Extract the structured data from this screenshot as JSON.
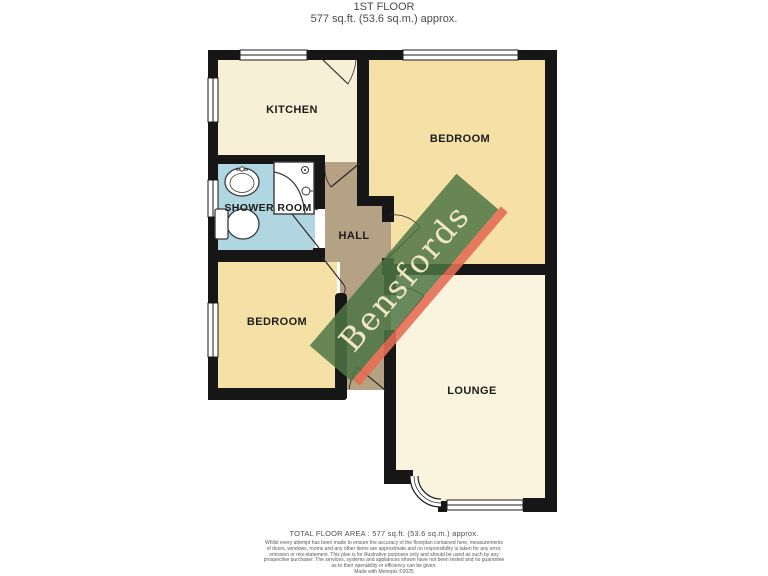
{
  "title": {
    "floor": "1ST FLOOR",
    "area": "577 sq.ft. (53.6 sq.m.) approx."
  },
  "rooms": {
    "kitchen": {
      "label": "KITCHEN"
    },
    "bedroom_right": {
      "label": "BEDROOM"
    },
    "shower_room": {
      "label": "SHOWER ROOM"
    },
    "hall": {
      "label": "HALL"
    },
    "bedroom_left": {
      "label": "BEDROOM"
    },
    "lounge": {
      "label": "LOUNGE"
    }
  },
  "watermark": {
    "text": "Bensfords",
    "band_color": "#5d8455",
    "shadow_color": "#e46e55",
    "text_color": "#f1e6c2"
  },
  "footer": {
    "total_area": "TOTAL FLOOR AREA : 577 sq.ft. (53.6 sq.m.) approx.",
    "disclaimer_lines": [
      "Whilst every attempt has been made to ensure the accuracy of the floorplan contained here, measurements",
      "of doors, windows, rooms and any other items are approximate and no responsibility is taken for any error,",
      "omission or mis-statement. This plan is for illustrative purposes only and should be used as such by any",
      "prospective purchaser. The services, systems and appliances shown have not been tested and no guarantee",
      "as to their operability or efficiency can be given.",
      "Made with Metropix ©2025"
    ]
  },
  "colors": {
    "wall": "#161616",
    "kitchen_floor": "#f7f0d6",
    "bedroom_floor": "#f5e1a6",
    "shower_floor": "#b0d7e1",
    "hall_floor": "#b5a183",
    "lounge_floor": "#faf4de"
  }
}
